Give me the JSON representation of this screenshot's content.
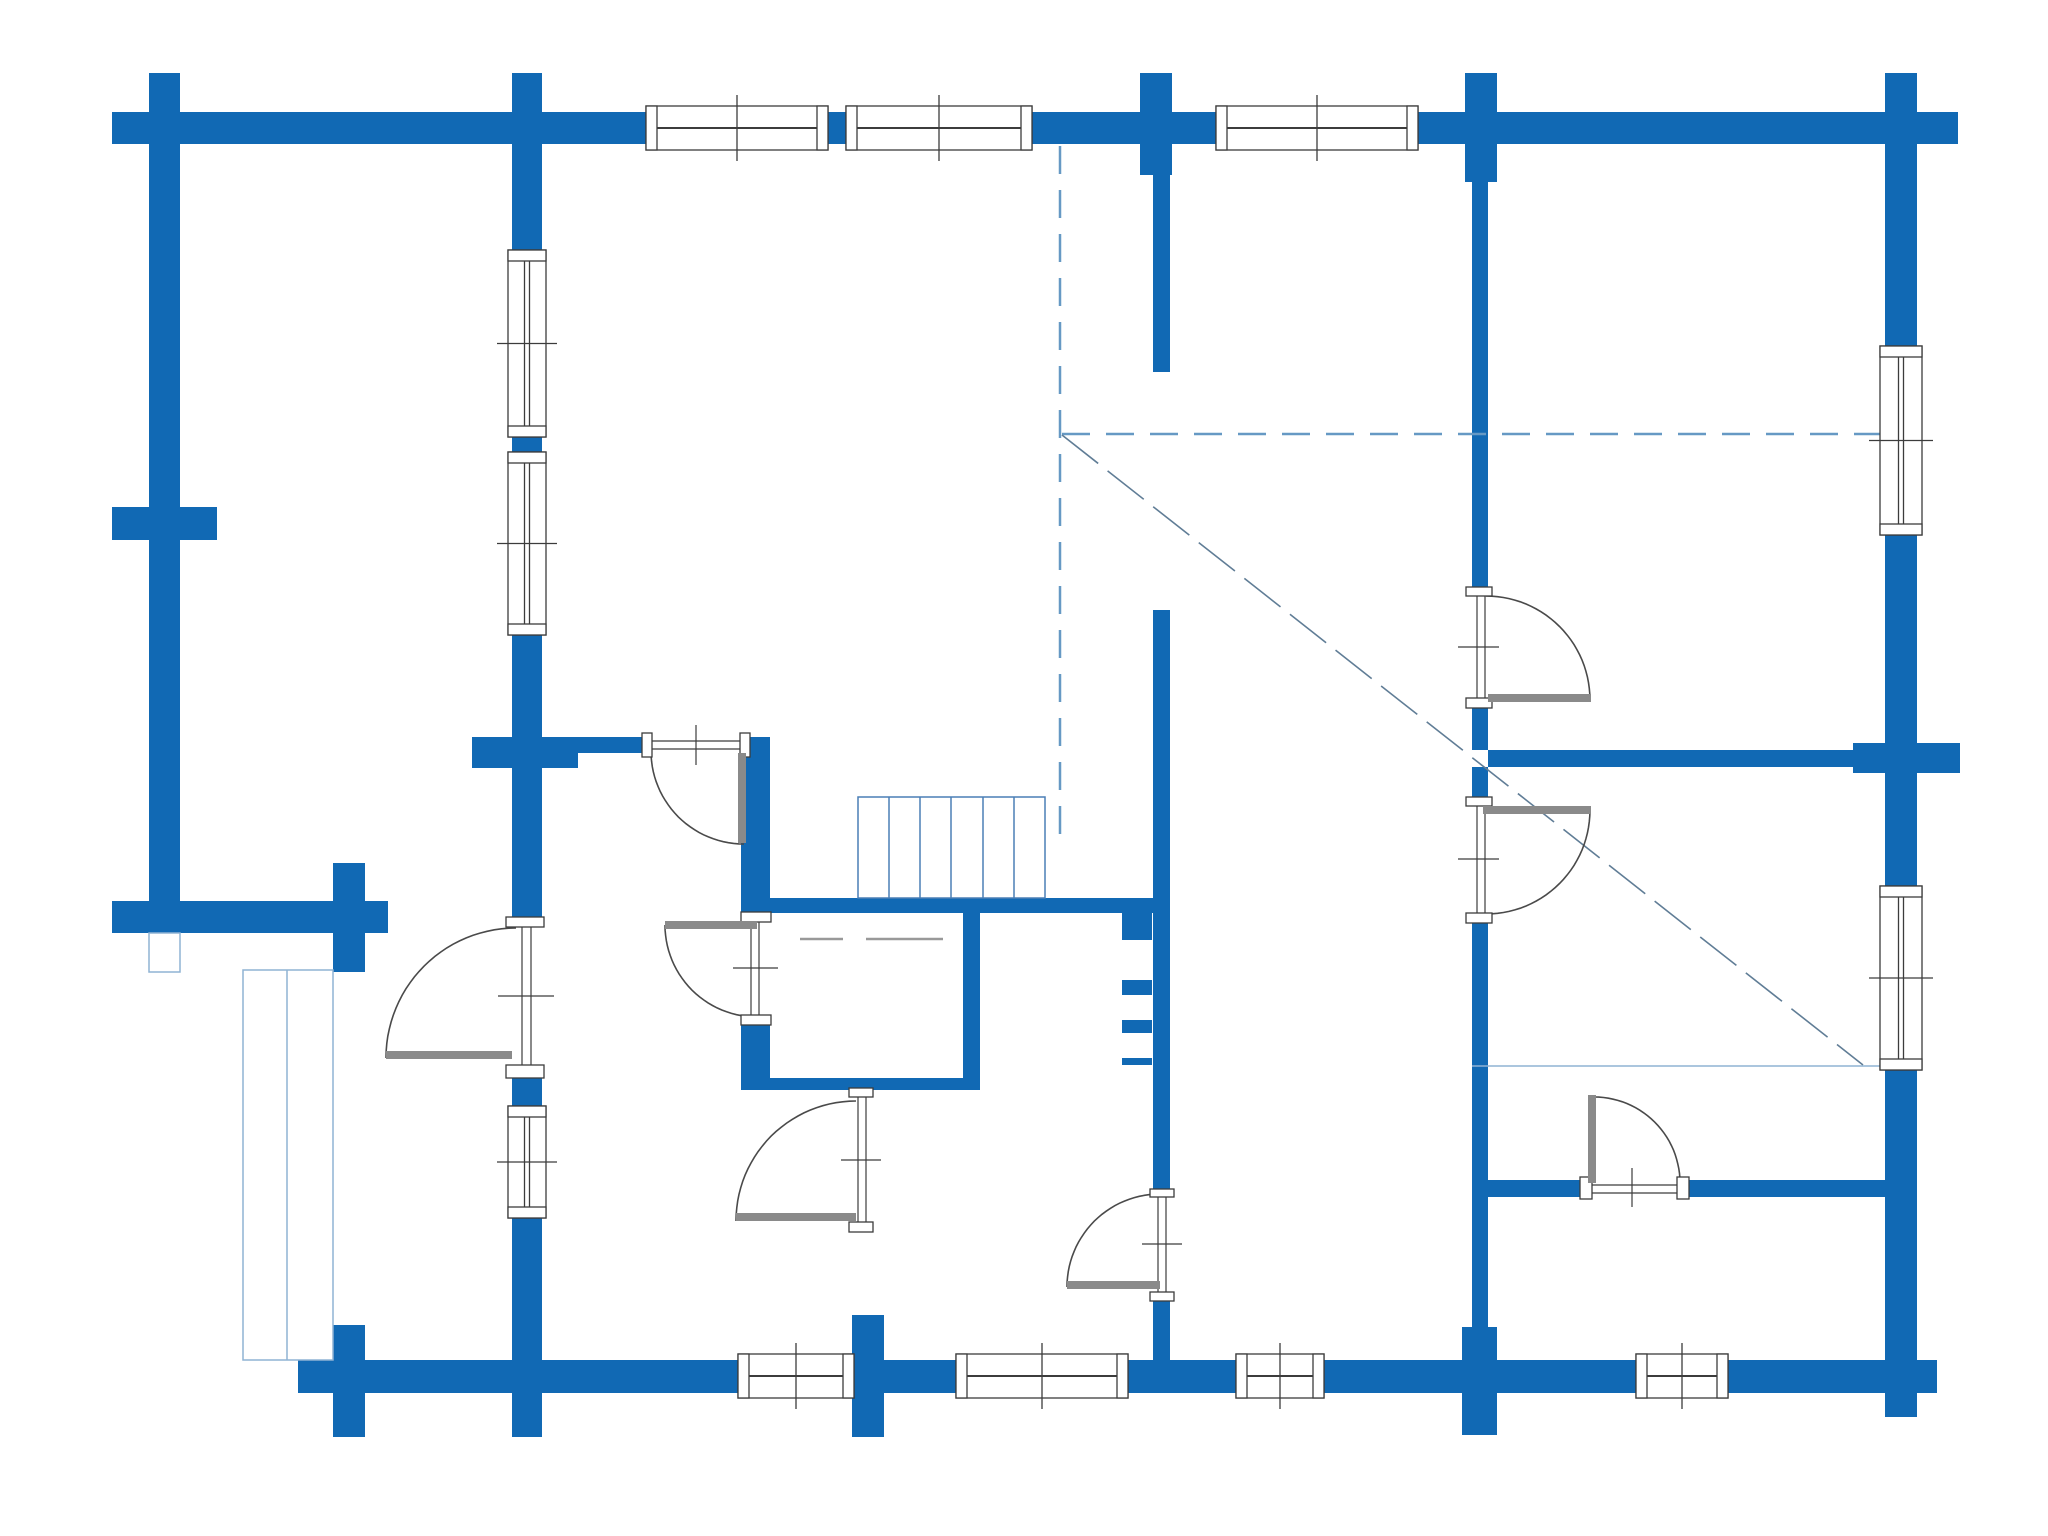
{
  "canvas": {
    "width": 2048,
    "height": 1536,
    "background": "#ffffff"
  },
  "colors": {
    "wall_blue": "#1169b4",
    "outline_dark": "#3c3c3c",
    "door_leaf_gray": "#8a8a8a",
    "arc_gray": "#4a4a4a",
    "dash_blue": "#6699c4",
    "diag_gray_blue": "#607d96",
    "thin_light_blue": "#8fb3d4",
    "stairs_blue": "#4a7fb5",
    "bench_gray": "#999999"
  },
  "walls": [
    {
      "n": "top-exterior-wall",
      "x": 112,
      "y": 112,
      "w": 1846,
      "h": 32
    },
    {
      "n": "left-wall-top-stub",
      "x": 149,
      "y": 73,
      "w": 31,
      "h": 39
    },
    {
      "n": "log-stub-top-512",
      "x": 512,
      "y": 73,
      "w": 30,
      "h": 39
    },
    {
      "n": "log-stub-top-1140",
      "x": 1140,
      "y": 73,
      "w": 32,
      "h": 39
    },
    {
      "n": "log-stub-top-1465",
      "x": 1465,
      "y": 73,
      "w": 32,
      "h": 39
    },
    {
      "n": "right-wall-top-stub",
      "x": 1885,
      "y": 73,
      "w": 32,
      "h": 39
    },
    {
      "n": "left-exterior-wall",
      "x": 149,
      "y": 144,
      "w": 31,
      "h": 789
    },
    {
      "n": "left-wall-cross-stub",
      "x": 112,
      "y": 507,
      "w": 105,
      "h": 33
    },
    {
      "n": "porch-top-wall",
      "x": 112,
      "y": 901,
      "w": 276,
      "h": 32
    },
    {
      "n": "porch-cross-stub",
      "x": 333,
      "y": 863,
      "w": 32,
      "h": 109
    },
    {
      "n": "right-wall-seg-a",
      "x": 1885,
      "y": 144,
      "w": 32,
      "h": 204
    },
    {
      "n": "right-wall-seg-b",
      "x": 1885,
      "y": 533,
      "w": 32,
      "h": 210
    },
    {
      "n": "right-wall-seg-c",
      "x": 1885,
      "y": 773,
      "w": 32,
      "h": 115
    },
    {
      "n": "right-wall-seg-d",
      "x": 1885,
      "y": 1068,
      "w": 32,
      "h": 349
    },
    {
      "n": "right-wall-through-stub",
      "x": 1853,
      "y": 743,
      "w": 107,
      "h": 30
    },
    {
      "n": "bottom-wall-seg-a",
      "x": 298,
      "y": 1360,
      "w": 440,
      "h": 33
    },
    {
      "n": "bottom-wall-seg-b",
      "x": 854,
      "y": 1360,
      "w": 104,
      "h": 33
    },
    {
      "n": "bottom-wall-seg-c",
      "x": 1128,
      "y": 1360,
      "w": 108,
      "h": 33
    },
    {
      "n": "bottom-wall-seg-d",
      "x": 1324,
      "y": 1360,
      "w": 312,
      "h": 33
    },
    {
      "n": "bottom-wall-seg-e",
      "x": 1728,
      "y": 1360,
      "w": 209,
      "h": 33
    },
    {
      "n": "bottom-cross-333",
      "x": 333,
      "y": 1325,
      "w": 32,
      "h": 112
    },
    {
      "n": "bottom-cross-512",
      "x": 512,
      "y": 1393,
      "w": 30,
      "h": 44
    },
    {
      "n": "bottom-cross-852",
      "x": 852,
      "y": 1315,
      "w": 32,
      "h": 122
    },
    {
      "n": "bottom-cross-1462",
      "x": 1462,
      "y": 1327,
      "w": 35,
      "h": 108
    },
    {
      "n": "window-wall-seg-a",
      "x": 512,
      "y": 144,
      "w": 30,
      "h": 106
    },
    {
      "n": "window-wall-pier",
      "x": 512,
      "y": 437,
      "w": 30,
      "h": 15
    },
    {
      "n": "window-wall-seg-b",
      "x": 512,
      "y": 633,
      "w": 30,
      "h": 284
    },
    {
      "n": "window-wall-seg-c",
      "x": 512,
      "y": 1078,
      "w": 30,
      "h": 30
    },
    {
      "n": "window-wall-seg-d",
      "x": 512,
      "y": 1216,
      "w": 30,
      "h": 144
    },
    {
      "n": "hall-wall-737-full",
      "x": 472,
      "y": 737,
      "w": 106,
      "h": 31
    },
    {
      "n": "hall-wall-737-half",
      "x": 578,
      "y": 737,
      "w": 64,
      "h": 16
    },
    {
      "n": "sauna-left-wall-a",
      "x": 741,
      "y": 737,
      "w": 29,
      "h": 176
    },
    {
      "n": "sauna-left-wall-b",
      "x": 741,
      "y": 1025,
      "w": 29,
      "h": 65
    },
    {
      "n": "sauna-right-wall",
      "x": 963,
      "y": 913,
      "w": 17,
      "h": 177
    },
    {
      "n": "sauna-bottom-wall",
      "x": 753,
      "y": 1078,
      "w": 227,
      "h": 12
    },
    {
      "n": "stairs-bottom-wall",
      "x": 770,
      "y": 898,
      "w": 400,
      "h": 15
    },
    {
      "n": "center-wall-stub-wide",
      "x": 1140,
      "y": 144,
      "w": 32,
      "h": 31
    },
    {
      "n": "center-wall-seg-a",
      "x": 1153,
      "y": 175,
      "w": 17,
      "h": 197
    },
    {
      "n": "center-wall-seg-b",
      "x": 1153,
      "y": 610,
      "w": 17,
      "h": 579
    },
    {
      "n": "center-wall-seg-c",
      "x": 1153,
      "y": 1300,
      "w": 17,
      "h": 60
    },
    {
      "n": "right-inner-wall-stub-wide",
      "x": 1465,
      "y": 144,
      "w": 32,
      "h": 38
    },
    {
      "n": "right-inner-wall-seg-a",
      "x": 1472,
      "y": 182,
      "w": 16,
      "h": 405
    },
    {
      "n": "right-inner-wall-seg-b",
      "x": 1472,
      "y": 708,
      "w": 16,
      "h": 42
    },
    {
      "n": "right-inner-wall-seg-c",
      "x": 1472,
      "y": 767,
      "w": 16,
      "h": 30
    },
    {
      "n": "right-inner-wall-seg-d",
      "x": 1472,
      "y": 913,
      "w": 16,
      "h": 414
    },
    {
      "n": "right-room-wall-750",
      "x": 1488,
      "y": 750,
      "w": 397,
      "h": 17
    },
    {
      "n": "right-room-wall-1180-a",
      "x": 1488,
      "y": 1180,
      "w": 92,
      "h": 17
    },
    {
      "n": "right-room-wall-1180-b",
      "x": 1688,
      "y": 1180,
      "w": 197,
      "h": 17
    }
  ],
  "windows": [
    {
      "n": "top-window-1",
      "o": "h",
      "x": 646,
      "y": 106,
      "w": 182,
      "h": 44,
      "double": false
    },
    {
      "n": "top-window-2",
      "o": "h",
      "x": 846,
      "y": 106,
      "w": 186,
      "h": 44,
      "double": false
    },
    {
      "n": "top-window-3",
      "o": "h",
      "x": 1216,
      "y": 106,
      "w": 202,
      "h": 44,
      "double": false
    },
    {
      "n": "bottom-window-0",
      "o": "h",
      "x": 738,
      "y": 1354,
      "w": 116,
      "h": 44,
      "double": false
    },
    {
      "n": "bottom-window-1",
      "o": "h",
      "x": 956,
      "y": 1354,
      "w": 172,
      "h": 44,
      "double": false
    },
    {
      "n": "bottom-window-2",
      "o": "h",
      "x": 1236,
      "y": 1354,
      "w": 88,
      "h": 44,
      "double": false
    },
    {
      "n": "bottom-window-3",
      "o": "h",
      "x": 1636,
      "y": 1354,
      "w": 92,
      "h": 44,
      "double": false
    },
    {
      "n": "left-wall-window-1",
      "o": "v",
      "x": 508,
      "y": 250,
      "w": 38,
      "h": 187,
      "double": true
    },
    {
      "n": "left-wall-window-2",
      "o": "v",
      "x": 508,
      "y": 452,
      "w": 38,
      "h": 183,
      "double": true
    },
    {
      "n": "left-wall-window-3",
      "o": "v",
      "x": 508,
      "y": 1106,
      "w": 38,
      "h": 112,
      "double": true
    },
    {
      "n": "right-wall-window-1",
      "o": "v",
      "x": 1880,
      "y": 346,
      "w": 42,
      "h": 189,
      "double": true
    },
    {
      "n": "right-wall-window-2",
      "o": "v",
      "x": 1880,
      "y": 886,
      "w": 42,
      "h": 184,
      "double": true
    }
  ],
  "doors": [
    {
      "n": "entry-door",
      "o": "v",
      "caps": [
        [
          506,
          917,
          38,
          10
        ],
        [
          506,
          1065,
          38,
          13
        ]
      ],
      "jambs": [
        [
          522,
          927,
          522,
          1065
        ],
        [
          531,
          927,
          531,
          1065
        ]
      ],
      "tick": [
        498,
        996,
        554,
        996
      ],
      "leaf": [
        386,
        1051,
        126,
        8
      ],
      "arc": {
        "cx": 516,
        "cy": 1058,
        "r": 130,
        "a0": 180,
        "a1": 270
      }
    },
    {
      "n": "sauna-door",
      "o": "v",
      "caps": [
        [
          741,
          912,
          30,
          10
        ],
        [
          741,
          1015,
          30,
          10
        ]
      ],
      "jambs": [
        [
          751,
          922,
          751,
          1015
        ],
        [
          759,
          922,
          759,
          1015
        ]
      ],
      "tick": [
        733,
        968,
        778,
        968
      ],
      "leaf": [
        665,
        921,
        92,
        8
      ],
      "arc": {
        "cx": 757,
        "cy": 925,
        "r": 92,
        "a0": 180,
        "a1": 90
      }
    },
    {
      "n": "hall-left-door",
      "o": "h",
      "caps": [
        [
          642,
          733,
          10,
          24
        ],
        [
          740,
          733,
          10,
          24
        ]
      ],
      "jambs": [
        [
          652,
          741,
          740,
          741
        ],
        [
          652,
          749,
          740,
          749
        ]
      ],
      "tick": [
        696,
        725,
        696,
        765
      ],
      "leaf": [
        738,
        753,
        8,
        90
      ],
      "arc": {
        "cx": 744,
        "cy": 751,
        "r": 93,
        "a0": 180,
        "a1": 90
      }
    },
    {
      "n": "wc-door",
      "o": "v",
      "caps": [
        [
          849,
          1088,
          24,
          9
        ],
        [
          849,
          1222,
          24,
          10
        ]
      ],
      "jambs": [
        [
          858,
          1097,
          858,
          1222
        ],
        [
          866,
          1097,
          866,
          1222
        ]
      ],
      "tick": [
        841,
        1160,
        881,
        1160
      ],
      "leaf": [
        736,
        1213,
        120,
        8
      ],
      "arc": {
        "cx": 856,
        "cy": 1221,
        "r": 120,
        "a0": 180,
        "a1": 270
      }
    },
    {
      "n": "right-upper-door",
      "o": "v",
      "caps": [
        [
          1466,
          587,
          26,
          9
        ],
        [
          1466,
          698,
          26,
          10
        ]
      ],
      "jambs": [
        [
          1477,
          596,
          1477,
          698
        ],
        [
          1485,
          596,
          1485,
          698
        ]
      ],
      "tick": [
        1458,
        647,
        1499,
        647
      ],
      "leaf": [
        1488,
        694,
        103,
        8
      ],
      "arc": {
        "cx": 1486,
        "cy": 700,
        "r": 104,
        "a0": 270,
        "a1": 360
      }
    },
    {
      "n": "right-middle-door",
      "o": "v",
      "caps": [
        [
          1466,
          797,
          26,
          9
        ],
        [
          1466,
          913,
          26,
          10
        ]
      ],
      "jambs": [
        [
          1477,
          806,
          1477,
          913
        ],
        [
          1485,
          806,
          1485,
          913
        ]
      ],
      "tick": [
        1458,
        859,
        1499,
        859
      ],
      "leaf": [
        1483,
        806,
        108,
        8
      ],
      "arc": {
        "cx": 1486,
        "cy": 810,
        "r": 104,
        "a0": 0,
        "a1": 90
      }
    },
    {
      "n": "hall-bottom-door",
      "o": "v",
      "caps": [
        [
          1150,
          1189,
          24,
          8
        ],
        [
          1150,
          1292,
          24,
          9
        ]
      ],
      "jambs": [
        [
          1158,
          1197,
          1158,
          1292
        ],
        [
          1166,
          1197,
          1166,
          1292
        ]
      ],
      "tick": [
        1142,
        1244,
        1182,
        1244
      ],
      "leaf": [
        1067,
        1281,
        93,
        8
      ],
      "arc": {
        "cx": 1160,
        "cy": 1287,
        "r": 93,
        "a0": 180,
        "a1": 270
      }
    },
    {
      "n": "right-room-door",
      "o": "h",
      "caps": [
        [
          1580,
          1177,
          12,
          22
        ],
        [
          1677,
          1177,
          12,
          22
        ]
      ],
      "jambs": [
        [
          1592,
          1185,
          1677,
          1185
        ],
        [
          1592,
          1193,
          1677,
          1193
        ]
      ],
      "tick": [
        1632,
        1168,
        1632,
        1207
      ],
      "leaf": [
        1588,
        1095,
        8,
        88
      ],
      "arc": {
        "cx": 1594,
        "cy": 1183,
        "r": 86,
        "a0": 270,
        "a1": 360
      }
    }
  ],
  "dashed_lines": [
    {
      "n": "roof-projection-vertical",
      "x1": 1060,
      "y1": 146,
      "x2": 1060,
      "y2": 845,
      "w": 2.5,
      "dash": "28,16",
      "color_key": "dash_blue"
    },
    {
      "n": "roof-projection-horizontal",
      "x1": 1062,
      "y1": 434,
      "x2": 1884,
      "y2": 434,
      "w": 2.5,
      "dash": "28,16",
      "color_key": "dash_blue"
    },
    {
      "n": "loft-diagonal",
      "x1": 1062,
      "y1": 435,
      "x2": 1863,
      "y2": 1065,
      "w": 1.6,
      "dash": "46,12",
      "color_key": "diag_gray_blue"
    }
  ],
  "thin_lines": [
    {
      "n": "loft-edge-line",
      "x1": 1472,
      "y1": 1066,
      "x2": 1884,
      "y2": 1066,
      "w": 1.5,
      "color_key": "thin_light_blue"
    },
    {
      "n": "bench-line-1",
      "x1": 800,
      "y1": 939,
      "x2": 843,
      "y2": 939,
      "w": 2.5,
      "color_key": "bench_gray"
    },
    {
      "n": "bench-line-2",
      "x1": 866,
      "y1": 939,
      "x2": 943,
      "y2": 939,
      "w": 2.5,
      "color_key": "bench_gray"
    }
  ],
  "stairs": {
    "n": "staircase",
    "x": 858,
    "y": 797,
    "w": 187,
    "h": 101,
    "treads": [
      889,
      920,
      951,
      983,
      1014
    ]
  },
  "ladder": {
    "n": "loft-ladder",
    "rungs": [
      [
        1122,
        913,
        30,
        27
      ],
      [
        1122,
        980,
        30,
        15
      ],
      [
        1122,
        1020,
        30,
        13
      ],
      [
        1122,
        1058,
        30,
        7
      ]
    ]
  },
  "deck": {
    "n": "porch-deck",
    "x": 243,
    "y": 970,
    "w": 90,
    "h": 390,
    "mid": 287
  },
  "post": {
    "n": "porch-post",
    "x": 149,
    "y": 933,
    "w": 31,
    "h": 39
  }
}
